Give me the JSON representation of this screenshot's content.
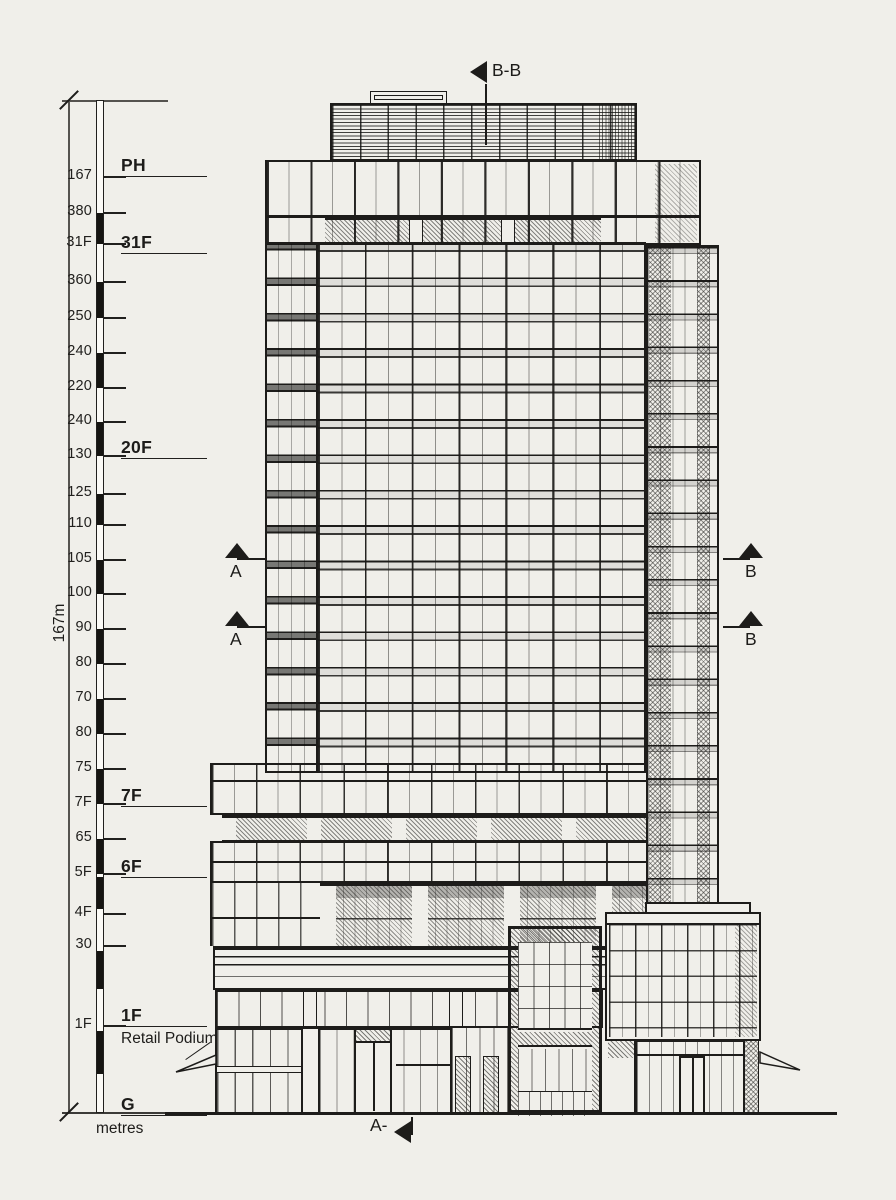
{
  "drawing": {
    "type": "architectural building elevation",
    "colors": {
      "ink": "#1d1c1a",
      "paper": "#f0efea"
    },
    "scale_bar": {
      "total_height": "167m",
      "unit": "metres",
      "ticks": [
        {
          "label": "167",
          "y": 176
        },
        {
          "label": "380",
          "y": 212
        },
        {
          "label": "31F",
          "y": 243
        },
        {
          "label": "360",
          "y": 281
        },
        {
          "label": "250",
          "y": 317
        },
        {
          "label": "240",
          "y": 352
        },
        {
          "label": "220",
          "y": 387
        },
        {
          "label": "240",
          "y": 421
        },
        {
          "label": "130",
          "y": 455
        },
        {
          "label": "125",
          "y": 493
        },
        {
          "label": "110",
          "y": 524
        },
        {
          "label": "105",
          "y": 559
        },
        {
          "label": "100",
          "y": 593
        },
        {
          "label": "90",
          "y": 628
        },
        {
          "label": "80",
          "y": 663
        },
        {
          "label": "70",
          "y": 698
        },
        {
          "label": "80",
          "y": 733
        },
        {
          "label": "75",
          "y": 768
        },
        {
          "label": "7F",
          "y": 803
        },
        {
          "label": "65",
          "y": 838
        },
        {
          "label": "5F",
          "y": 873
        },
        {
          "label": "4F",
          "y": 913
        },
        {
          "label": "30",
          "y": 945
        },
        {
          "label": "1F",
          "y": 1025
        }
      ],
      "bar_segments_black": [
        [
          212,
          243
        ],
        [
          281,
          317
        ],
        [
          352,
          387
        ],
        [
          421,
          455
        ],
        [
          493,
          524
        ],
        [
          559,
          593
        ],
        [
          628,
          663
        ],
        [
          698,
          733
        ],
        [
          768,
          803
        ],
        [
          838,
          873
        ],
        [
          876,
          908
        ],
        [
          950,
          988
        ],
        [
          1030,
          1073
        ]
      ],
      "floor_labels": [
        {
          "label": "PH",
          "y": 155
        },
        {
          "label": "31F",
          "y": 232
        },
        {
          "label": "20F",
          "y": 437
        },
        {
          "label": "7F",
          "y": 785
        },
        {
          "label": "6F",
          "y": 856
        },
        {
          "label": "1F",
          "y": 1005,
          "sublabel": "Retail Podium"
        },
        {
          "label": "G",
          "y": 1094
        }
      ]
    },
    "section_markers": {
      "top": {
        "label": "B-B"
      },
      "left": [
        {
          "label": "A",
          "y": 543
        },
        {
          "label": "A",
          "y": 611
        }
      ],
      "right": [
        {
          "label": "B",
          "y": 543
        },
        {
          "label": "B",
          "y": 611
        }
      ],
      "bottom": {
        "label": "A-"
      }
    }
  }
}
